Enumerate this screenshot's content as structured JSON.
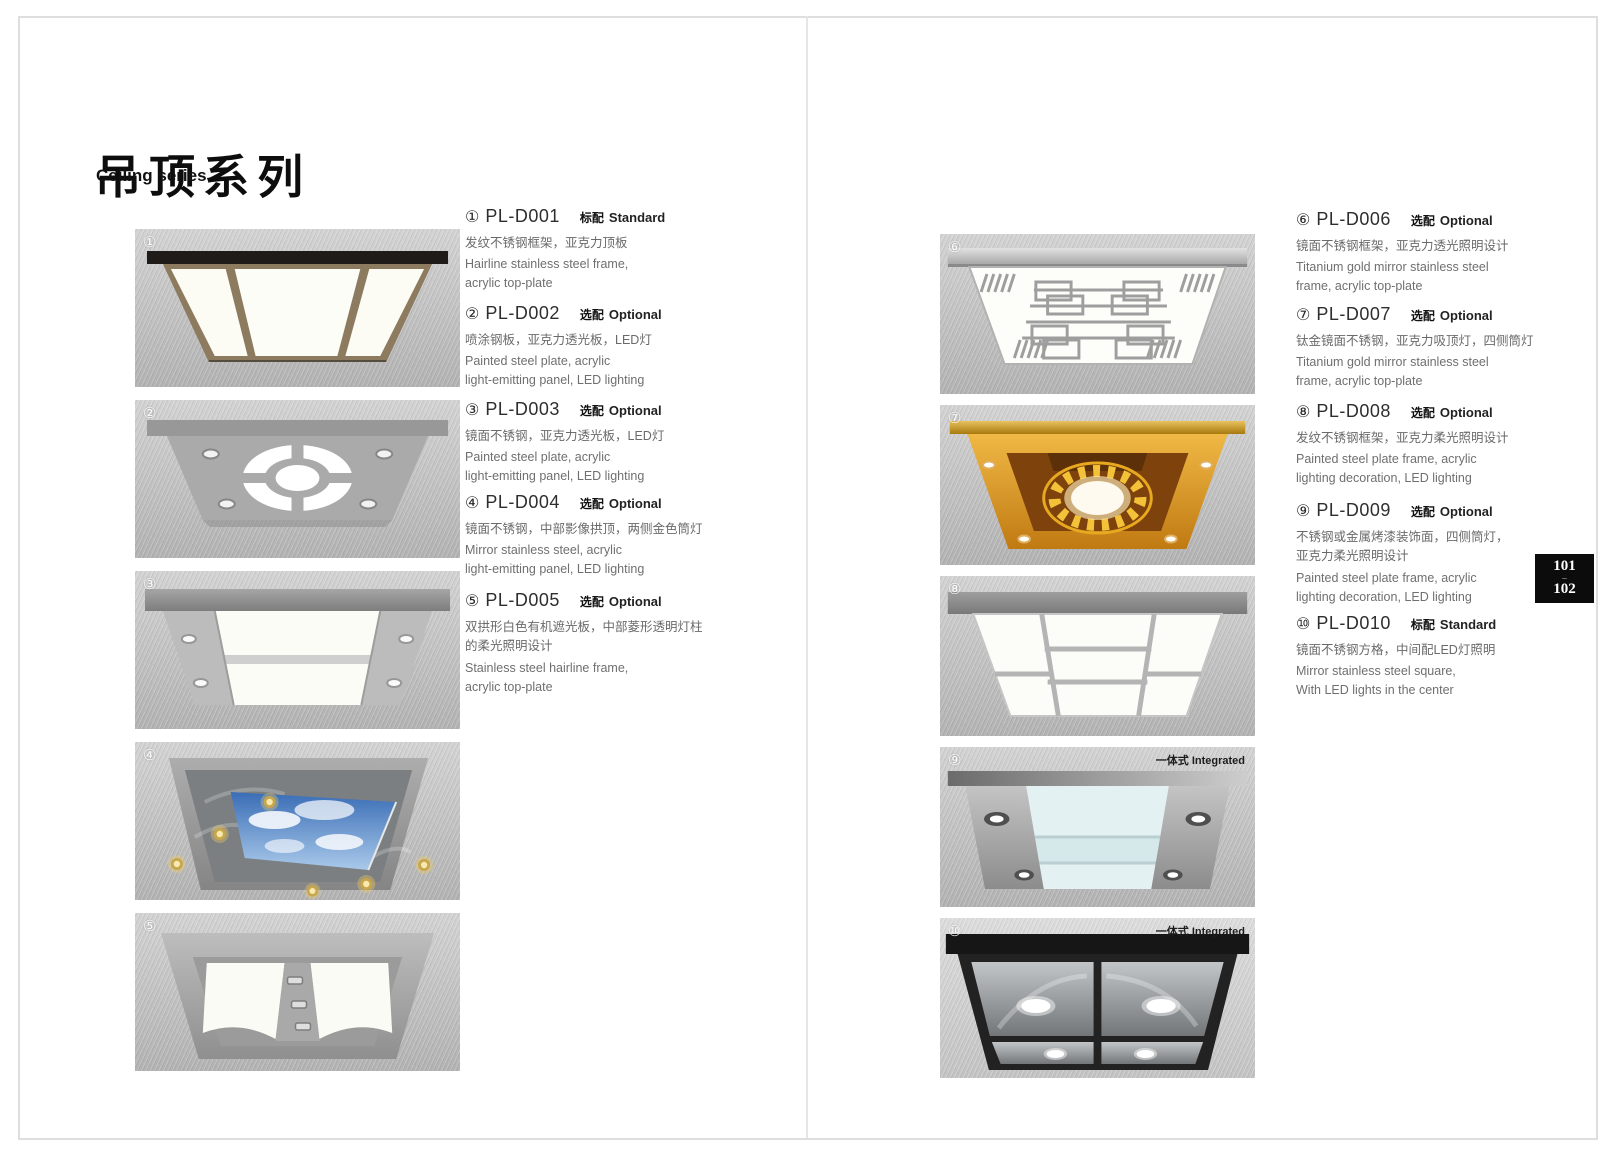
{
  "page": {
    "title_zh": "吊顶系列",
    "title_en": "Ceiling series",
    "integrated_label": "一体式 Integrated",
    "badge_top": "101",
    "badge_sep": "–",
    "badge_bottom": "102"
  },
  "colors": {
    "badge_bg": "#0c0c0c",
    "badge_text": "#ffffff",
    "gold_accent": "#d99b28",
    "panel_glow": "#fdfdf8"
  },
  "products": [
    {
      "num": "①",
      "code": "PL-D001",
      "tag_zh": "标配",
      "tag_en": "Standard",
      "desc_zh": "发纹不锈钢框架，亚克力顶板",
      "desc_en": "Hairline stainless steel frame,\nacrylic top-plate"
    },
    {
      "num": "②",
      "code": "PL-D002",
      "tag_zh": "选配",
      "tag_en": "Optional",
      "desc_zh": "喷涂钢板，亚克力透光板，LED灯",
      "desc_en": "Painted steel plate, acrylic\nlight-emitting panel, LED  lighting"
    },
    {
      "num": "③",
      "code": "PL-D003",
      "tag_zh": "选配",
      "tag_en": "Optional",
      "desc_zh": "镜面不锈钢，亚克力透光板，LED灯",
      "desc_en": "Painted steel plate, acrylic\nlight-emitting panel, LED  lighting"
    },
    {
      "num": "④",
      "code": "PL-D004",
      "tag_zh": "选配",
      "tag_en": "Optional",
      "desc_zh": "镜面不锈钢，中部影像拱顶，两侧金色筒灯",
      "desc_en": "Mirror stainless steel, acrylic\nlight-emitting panel, LED  lighting"
    },
    {
      "num": "⑤",
      "code": "PL-D005",
      "tag_zh": "选配",
      "tag_en": "Optional",
      "desc_zh": "双拱形白色有机遮光板，中部菱形透明灯柱\n的柔光照明设计",
      "desc_en": "Stainless steel hairline frame,\nacrylic top-plate"
    },
    {
      "num": "⑥",
      "code": "PL-D006",
      "tag_zh": "选配",
      "tag_en": "Optional",
      "desc_zh": "镜面不锈钢框架，亚克力透光照明设计",
      "desc_en": "Titanium gold mirror stainless steel\nframe, acrylic top-plate"
    },
    {
      "num": "⑦",
      "code": "PL-D007",
      "tag_zh": "选配",
      "tag_en": "Optional",
      "desc_zh": "钛金镜面不锈钢，亚克力吸顶灯，四侧筒灯",
      "desc_en": "Titanium gold mirror stainless steel\nframe, acrylic top-plate"
    },
    {
      "num": "⑧",
      "code": "PL-D008",
      "tag_zh": "选配",
      "tag_en": "Optional",
      "desc_zh": "发纹不锈钢框架，亚克力柔光照明设计",
      "desc_en": "Painted steel plate frame, acrylic\nlighting decoration, LED  lighting"
    },
    {
      "num": "⑨",
      "code": "PL-D009",
      "tag_zh": "选配",
      "tag_en": "Optional",
      "desc_zh": "不锈钢或金属烤漆装饰面，四侧筒灯，\n亚克力柔光照明设计",
      "desc_en": "Painted steel plate frame, acrylic\nlighting decoration, LED  lighting"
    },
    {
      "num": "⑩",
      "code": "PL-D010",
      "tag_zh": "标配",
      "tag_en": "Standard",
      "desc_zh": "镜面不锈钢方格，中间配LED灯照明",
      "desc_en": "Mirror stainless steel square,\nWith LED lights in the center"
    }
  ]
}
